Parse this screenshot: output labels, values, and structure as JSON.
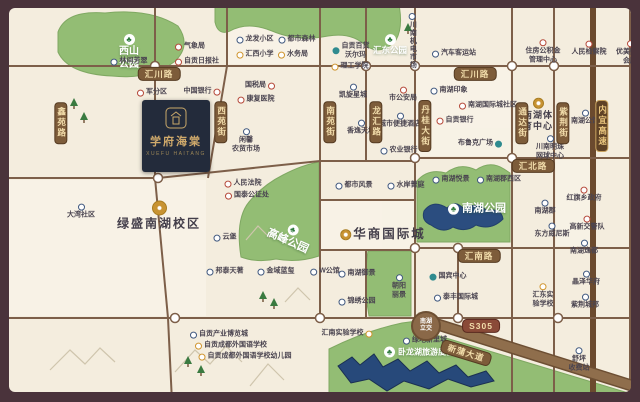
{
  "meta": {
    "type": "real-estate-location-map",
    "tree_glyph": "♣",
    "colors": {
      "frame": "#4a333b",
      "map_bg": "#f4edde",
      "park_green": "#93bd74",
      "lake_blue": "#2b4d7f",
      "road_brown": "#7d5f49",
      "banner_bg": "#7d5c3a",
      "banner_text": "#f2ddab",
      "logo_navy": "#232b3b",
      "logo_gold": "#cfa96b",
      "icon_red": "#b5493a",
      "icon_blue": "#41597f",
      "icon_yellow": "#d0952f",
      "icon_teal": "#2f8b8f"
    }
  },
  "logo": {
    "title": "学府海棠",
    "latin": "XUEFU HAITANG"
  },
  "interchange": {
    "t": [
      "南湖",
      "立交"
    ],
    "x": 417,
    "y": 318
  },
  "road_banners": [
    {
      "t": "鑫苑路",
      "x": 52,
      "y": 115
    },
    {
      "t": "西苑街",
      "x": 212,
      "y": 114
    },
    {
      "t": "南苑街",
      "x": 321,
      "y": 114
    },
    {
      "t": "龙汇路",
      "x": 367,
      "y": 114
    },
    {
      "t": "丹桂大街",
      "x": 416,
      "y": 118
    },
    {
      "t": "通达街",
      "x": 513,
      "y": 115
    },
    {
      "t": "紫荆街",
      "x": 554,
      "y": 115
    },
    {
      "t": "内宜高速",
      "x": 593,
      "y": 118,
      "hw": true
    }
  ],
  "road_badges": [
    {
      "t": "汇川路",
      "x": 150,
      "y": 66
    },
    {
      "t": "汇川路",
      "x": 466,
      "y": 66
    },
    {
      "t": "汇北路",
      "x": 524,
      "y": 158
    },
    {
      "t": "汇南路",
      "x": 470,
      "y": 248
    },
    {
      "t": "S305",
      "x": 472,
      "y": 318,
      "s305": true
    },
    {
      "t": "新蒲大道",
      "x": 457,
      "y": 345,
      "rot": 17,
      "s305": false
    }
  ],
  "park_labels": [
    {
      "t": "西山公园",
      "lines": [
        "西山",
        "公园"
      ],
      "x": 120,
      "y": 44,
      "s": 10
    },
    {
      "t": "汇东公园",
      "lines": [
        "汇东公园"
      ],
      "x": 381,
      "y": 37,
      "s": 8.5
    },
    {
      "t": "高峰公园",
      "lines": [
        "高峰公园"
      ],
      "x": 281,
      "y": 228,
      "s": 11,
      "rot": 24
    },
    {
      "t": "南湖公园",
      "lines": [
        "南湖公园"
      ],
      "x": 468,
      "y": 201,
      "s": 11,
      "side": true
    },
    {
      "t": "卧龙湖旅游度假区",
      "lines": [
        "卧龙湖旅游度假区"
      ],
      "x": 414,
      "y": 344,
      "s": 8,
      "side": true
    }
  ],
  "pois": [
    {
      "t": [
        "林间芳翠"
      ],
      "x": 120,
      "y": 54,
      "c": "blue",
      "i": "l"
    },
    {
      "t": [
        "气象局"
      ],
      "x": 181,
      "y": 39,
      "c": "red",
      "i": "l"
    },
    {
      "t": [
        "自贡日报社"
      ],
      "x": 188,
      "y": 54,
      "c": "red",
      "i": "l"
    },
    {
      "t": [
        "军分区"
      ],
      "x": 143,
      "y": 85,
      "c": "red",
      "i": "l"
    },
    {
      "t": [
        "中国银行"
      ],
      "x": 193,
      "y": 84,
      "c": "red",
      "i": "r"
    },
    {
      "t": [
        "龙发小区"
      ],
      "x": 246,
      "y": 32,
      "c": "blue",
      "i": "l"
    },
    {
      "t": [
        "汇西小学"
      ],
      "x": 246,
      "y": 47,
      "c": "yellow",
      "i": "l"
    },
    {
      "t": [
        "都市森林"
      ],
      "x": 288,
      "y": 32,
      "c": "blue",
      "i": "l"
    },
    {
      "t": [
        "水务局"
      ],
      "x": 284,
      "y": 47,
      "c": "yellow",
      "i": "l"
    },
    {
      "t": [
        "自贡百货",
        "沃尔玛"
      ],
      "x": 342,
      "y": 43,
      "c": "teal",
      "i": "l"
    },
    {
      "t": [
        "理工学院"
      ],
      "x": 341,
      "y": 59,
      "c": "yellow",
      "i": "l"
    },
    {
      "t": [
        "川南机电市场"
      ],
      "x": 403,
      "y": 33,
      "c": "blue",
      "i": "t",
      "vert": true
    },
    {
      "t": [
        "汽车客运站"
      ],
      "x": 445,
      "y": 46,
      "c": "blue",
      "i": "l"
    },
    {
      "t": [
        "住房公积金",
        "管理中心"
      ],
      "x": 534,
      "y": 44,
      "c": "red",
      "i": "t"
    },
    {
      "t": [
        "人民检察院"
      ],
      "x": 580,
      "y": 41,
      "c": "red",
      "i": "t"
    },
    {
      "t": [
        "优美购物",
        "会所"
      ],
      "x": 621,
      "y": 45,
      "c": "red",
      "i": "t"
    },
    {
      "t": [
        "国税局"
      ],
      "x": 251,
      "y": 78,
      "c": "red",
      "i": "r"
    },
    {
      "t": [
        "康复医院"
      ],
      "x": 247,
      "y": 92,
      "c": "red",
      "i": "l"
    },
    {
      "t": [
        "闲馨",
        "农贸市场"
      ],
      "x": 237,
      "y": 133,
      "c": "blue",
      "i": "t"
    },
    {
      "t": [
        "凯旋星城"
      ],
      "x": 344,
      "y": 84,
      "c": "blue",
      "i": "t"
    },
    {
      "t": [
        "香逸天地"
      ],
      "x": 352,
      "y": 120,
      "c": "blue",
      "i": "t"
    },
    {
      "t": [
        "市公安局"
      ],
      "x": 394,
      "y": 87,
      "c": "red",
      "i": "t"
    },
    {
      "t": [
        "城市便捷酒店"
      ],
      "x": 391,
      "y": 113,
      "c": "blue",
      "i": "t"
    },
    {
      "t": [
        "农业银行"
      ],
      "x": 390,
      "y": 143,
      "c": "blue",
      "i": "l"
    },
    {
      "t": [
        "南湖印象"
      ],
      "x": 440,
      "y": 83,
      "c": "blue",
      "i": "l"
    },
    {
      "t": [
        "南湖国际城社区"
      ],
      "x": 479,
      "y": 98,
      "c": "red",
      "i": "l"
    },
    {
      "t": [
        "自贡银行"
      ],
      "x": 446,
      "y": 113,
      "c": "red",
      "i": "l"
    },
    {
      "t": [
        "布鲁克广场"
      ],
      "x": 471,
      "y": 136,
      "c": "teal",
      "i": "r"
    },
    {
      "t": [
        "南湖体",
        "育中心"
      ],
      "x": 529,
      "y": 107,
      "c": "gold",
      "i": "t",
      "big": "b3"
    },
    {
      "t": [
        "川南明珠",
        "网球中心"
      ],
      "x": 541,
      "y": 140,
      "c": "blue",
      "i": "t"
    },
    {
      "t": [
        "南湖公馆"
      ],
      "x": 576,
      "y": 110,
      "c": "blue",
      "i": "t"
    },
    {
      "t": [
        "南湖悦景"
      ],
      "x": 442,
      "y": 172,
      "c": "blue",
      "i": "l"
    },
    {
      "t": [
        "南湖郡西区"
      ],
      "x": 490,
      "y": 172,
      "c": "blue",
      "i": "l"
    },
    {
      "t": [
        "南湖郡"
      ],
      "x": 536,
      "y": 200,
      "c": "blue",
      "i": "t"
    },
    {
      "t": [
        "东方威尼斯"
      ],
      "x": 543,
      "y": 223,
      "c": "blue",
      "i": "t"
    },
    {
      "t": [
        "红旗乡政府"
      ],
      "x": 575,
      "y": 187,
      "c": "red",
      "i": "t"
    },
    {
      "t": [
        "高新交警队"
      ],
      "x": 578,
      "y": 216,
      "c": "red",
      "i": "t"
    },
    {
      "t": [
        "南湖逸都"
      ],
      "x": 575,
      "y": 240,
      "c": "blue",
      "i": "t"
    },
    {
      "t": [
        "人民法院"
      ],
      "x": 234,
      "y": 176,
      "c": "red",
      "i": "l"
    },
    {
      "t": [
        "国泰公证处"
      ],
      "x": 238,
      "y": 188,
      "c": "red",
      "i": "l"
    },
    {
      "t": [
        "云堡"
      ],
      "x": 216,
      "y": 230,
      "c": "blue",
      "i": "l"
    },
    {
      "t": [
        "都市风景"
      ],
      "x": 345,
      "y": 178,
      "c": "blue",
      "i": "l"
    },
    {
      "t": [
        "水岸菁庭"
      ],
      "x": 397,
      "y": 178,
      "c": "blue",
      "i": "l"
    },
    {
      "t": [
        "大湾社区"
      ],
      "x": 72,
      "y": 204,
      "c": "blue",
      "i": "t"
    },
    {
      "t": [
        "邦泰天著"
      ],
      "x": 216,
      "y": 264,
      "c": "blue",
      "i": "l"
    },
    {
      "t": [
        "金域蓝玺"
      ],
      "x": 267,
      "y": 264,
      "c": "blue",
      "i": "l"
    },
    {
      "t": [
        "W公馆"
      ],
      "x": 316,
      "y": 264,
      "c": "blue",
      "i": "l"
    },
    {
      "t": [
        "南湖御景"
      ],
      "x": 348,
      "y": 266,
      "c": "blue",
      "i": "l"
    },
    {
      "t": [
        "锦绣公园"
      ],
      "x": 348,
      "y": 294,
      "c": "blue",
      "i": "l"
    },
    {
      "t": [
        "朝阳",
        "丽景"
      ],
      "x": 390,
      "y": 279,
      "c": "blue",
      "i": "t"
    },
    {
      "t": [
        "国宾中心"
      ],
      "x": 439,
      "y": 269,
      "c": "teal",
      "i": "l"
    },
    {
      "t": [
        "泰丰国际城"
      ],
      "x": 447,
      "y": 290,
      "c": "blue",
      "i": "l"
    },
    {
      "t": [
        "晶泽华府"
      ],
      "x": 577,
      "y": 271,
      "c": "blue",
      "i": "t"
    },
    {
      "t": [
        "紫荆城邦"
      ],
      "x": 576,
      "y": 294,
      "c": "blue",
      "i": "t"
    },
    {
      "t": [
        "汇东实",
        "验学校"
      ],
      "x": 534,
      "y": 288,
      "c": "yellow",
      "i": "t"
    },
    {
      "t": [
        "汇南实验学校"
      ],
      "x": 338,
      "y": 326,
      "c": "yellow",
      "i": "r"
    },
    {
      "t": [
        "绿地新里城"
      ],
      "x": 416,
      "y": 333,
      "c": "blue",
      "i": "l"
    },
    {
      "t": [
        "舒坪",
        "收费站"
      ],
      "x": 570,
      "y": 352,
      "c": "blue",
      "i": "t"
    },
    {
      "t": [
        "自贡产业博览城"
      ],
      "x": 210,
      "y": 327,
      "c": "blue",
      "i": "l"
    },
    {
      "t": [
        "自贡成都外国语学校"
      ],
      "x": 222,
      "y": 338,
      "c": "yellow",
      "i": "l"
    },
    {
      "t": [
        "自贡成都外国语学校幼儿园"
      ],
      "x": 236,
      "y": 349,
      "c": "yellow",
      "i": "l"
    },
    {
      "t": [
        "绿盛南湖校区"
      ],
      "x": 150,
      "y": 208,
      "c": "goldbook",
      "i": "t",
      "big": "b1"
    },
    {
      "t": [
        "华商国际城"
      ],
      "x": 374,
      "y": 227,
      "c": "goldshop",
      "i": "l",
      "big": "b2"
    }
  ]
}
